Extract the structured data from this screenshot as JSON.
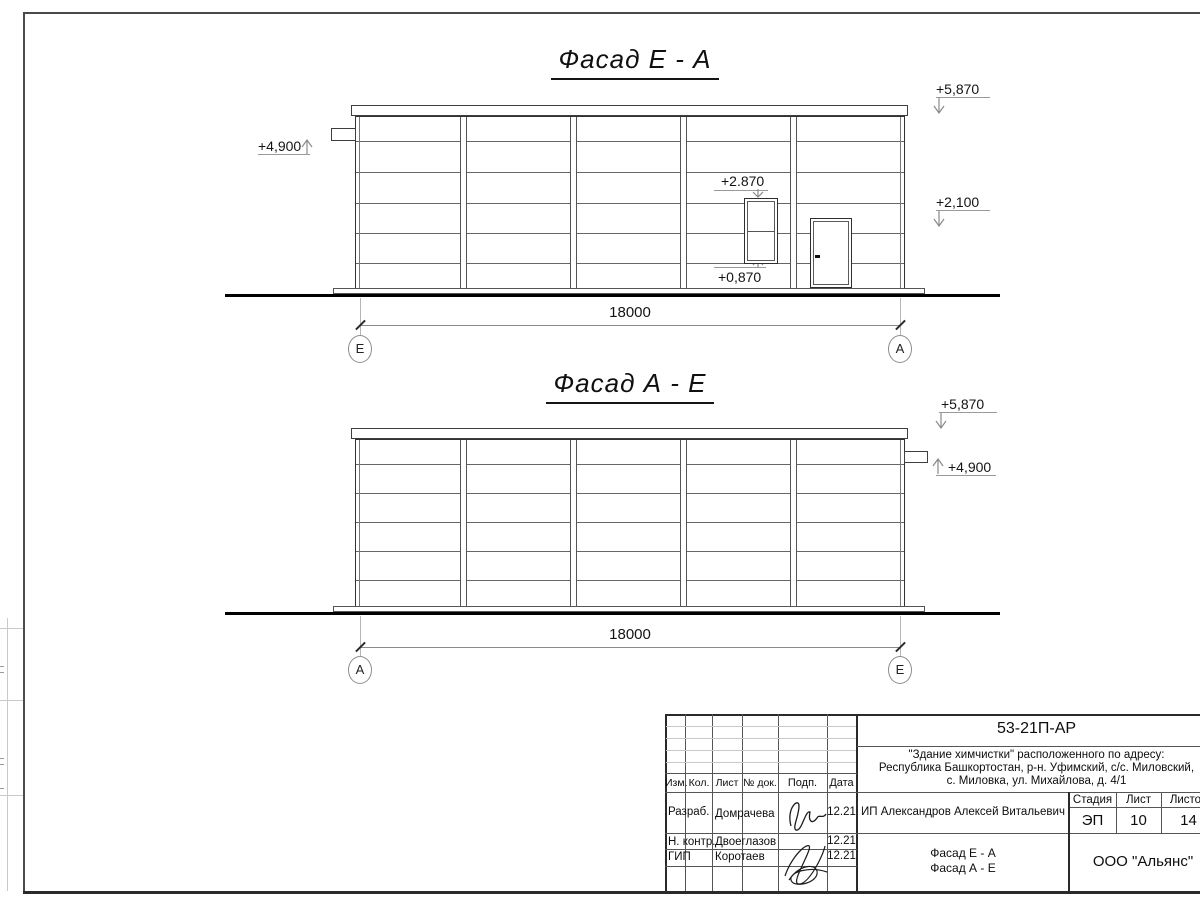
{
  "drawing": {
    "facade1": {
      "title": "Фасад Е - А",
      "dim": "18000",
      "axis_left": "Е",
      "axis_right": "А",
      "mark_4900": "+4,900",
      "mark_5870": "+5,870",
      "mark_2870": "+2.870",
      "mark_2100": "+2,100",
      "mark_0870": "+0,870"
    },
    "facade2": {
      "title": "Фасад А - Е",
      "dim": "18000",
      "axis_left": "А",
      "axis_right": "Е",
      "mark_5870": "+5,870",
      "mark_4900": "+4,900"
    }
  },
  "titleblock": {
    "doc_code": "53-21П-АР",
    "project_line1": "\"Здание химчистки\" расположенного по адресу:",
    "project_line2": "Республика Башкортостан, р-н. Уфимский, с/с. Миловский,",
    "project_line3": "с. Миловка, ул. Михайлова, д. 4/1",
    "col_izm": "Изм.",
    "col_kol": "Кол.",
    "col_list": "Лист",
    "col_ndok": "№ док.",
    "col_podp": "Подп.",
    "col_data": "Дата",
    "rows": [
      {
        "role": "Разраб.",
        "name": "Домрачева",
        "date": "12.21"
      },
      {
        "role": "Н. контр.",
        "name": "Двоеглазов",
        "date": "12.21"
      },
      {
        "role": "ГИП",
        "name": "Коротаев",
        "date": "12.21"
      }
    ],
    "client": "ИП Александров Алексей Витальевич",
    "stage_label": "Стадия",
    "sheet_label": "Лист",
    "sheets_label": "Листов",
    "stage": "ЭП",
    "sheet": "10",
    "sheets": "14",
    "sheet_title_line1": "Фасад Е - А",
    "sheet_title_line2": "Фасад А - Е",
    "company": "ООО \"Альянс\""
  }
}
